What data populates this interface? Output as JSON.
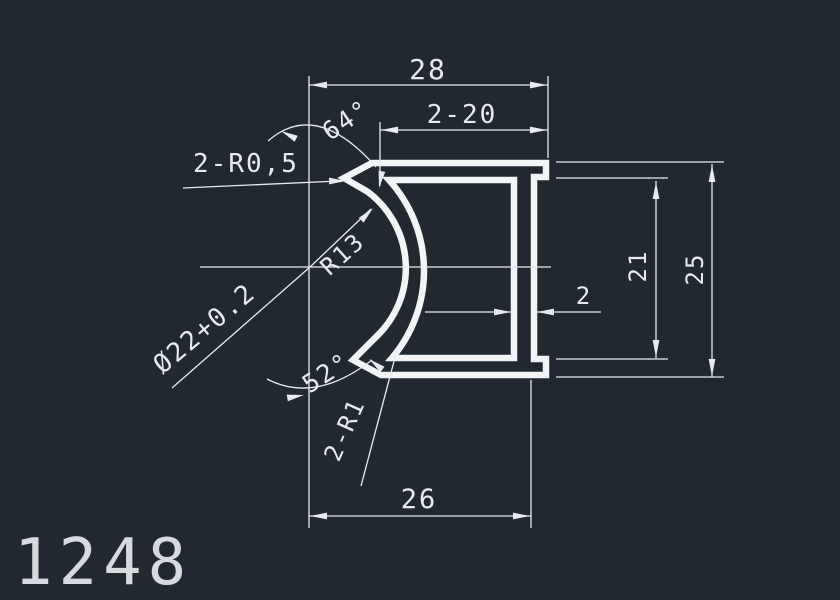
{
  "canvas": {
    "background_color": "#212830",
    "line_color": "#e7ebef"
  },
  "part_number": "1248",
  "dims": {
    "total_width": "28",
    "double_twenty": "2-20",
    "angle_top": "64°",
    "tip_radius": "2-R0,5",
    "arc_radius": "R13",
    "bore_diameter": "Ø22+0.2",
    "angle_bottom": "52°",
    "double_fillet": "2-R1",
    "wall_thickness": "2",
    "inner_height": "21",
    "total_height": "25",
    "bottom_width": "26"
  }
}
